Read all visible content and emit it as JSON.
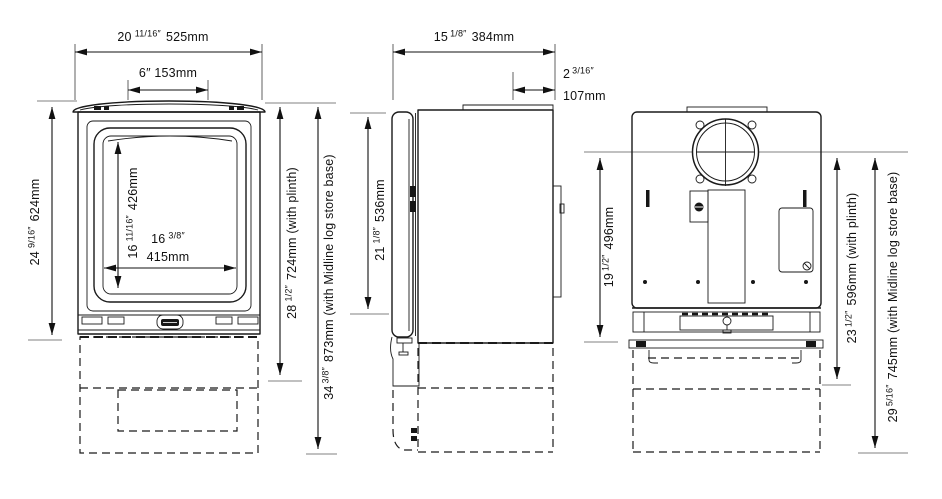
{
  "diagram_title": "Stove dimension drawing (front, side and rear views)",
  "colors": {
    "line": "#1a1a1a",
    "dim_text": "#111111",
    "tick": "#9a9a9a",
    "background": "#ffffff"
  },
  "front": {
    "overall_width": {
      "num": "20",
      "frac": "11/16″",
      "rest": "525mm"
    },
    "top_width_label": "6″ 153mm",
    "body_height": {
      "num": "24",
      "frac": "9/16″",
      "rest": "624mm"
    },
    "glass_height": {
      "num": "16",
      "frac": "11/16″",
      "rest": "426mm"
    },
    "glass_width_in": {
      "num": "16",
      "frac": "3/8″"
    },
    "glass_width_mm": "415mm",
    "height_with_plinth": {
      "num": "28",
      "frac": "1/2″",
      "rest": "724mm (with plinth)"
    },
    "height_with_log_store": {
      "num": "34",
      "frac": "3/8″",
      "rest": "873mm (with Midline log store base)"
    }
  },
  "side": {
    "depth": {
      "num": "15",
      "frac": "1/8″",
      "rest": "384mm"
    },
    "rear_offset_in": {
      "num": "2",
      "frac": "3/16″"
    },
    "rear_offset_mm": "107mm",
    "door_height": {
      "num": "21",
      "frac": "1/8″",
      "rest": "536mm"
    }
  },
  "rear": {
    "flue_centre_height": {
      "num": "19",
      "frac": "1/2″",
      "rest": "496mm"
    },
    "flue_centre_height_with_plinth": {
      "num": "23",
      "frac": "1/2″",
      "rest": "596mm (with plinth)"
    },
    "flue_centre_height_with_log_store": {
      "num": "29",
      "frac": "5/16″",
      "rest": "745mm (with Midline log store base)"
    }
  }
}
